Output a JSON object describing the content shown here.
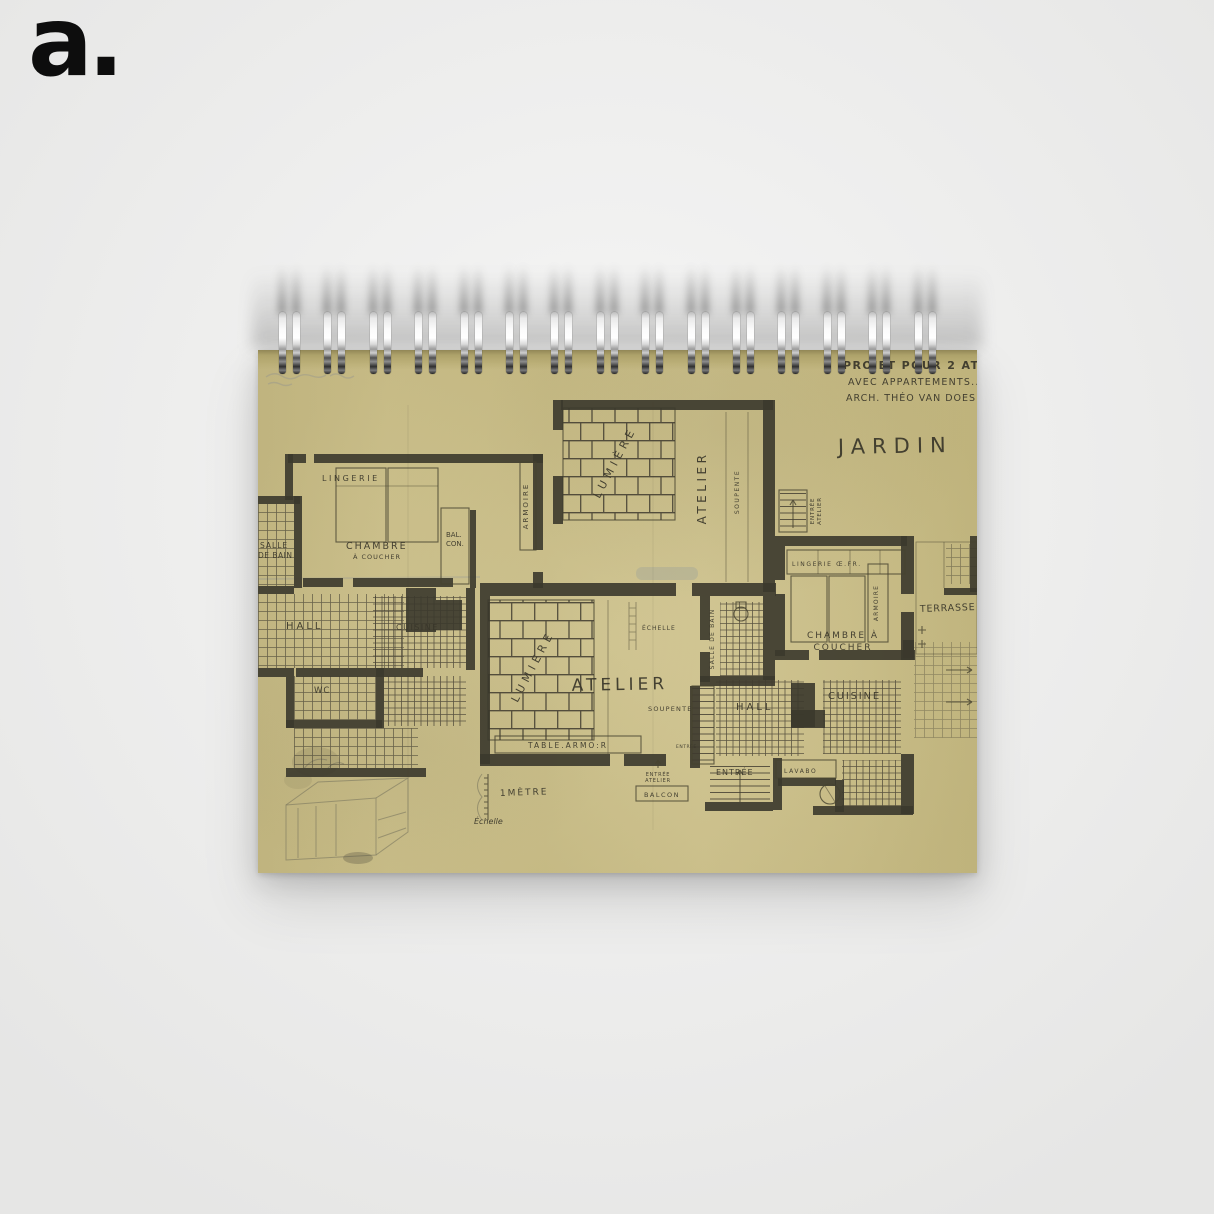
{
  "brand": {
    "logo_text": "a."
  },
  "colors": {
    "background": "#ededec",
    "page": "#cdc18b",
    "ink": "#3b382c",
    "logo": "#0d0d0d"
  },
  "notebook": {
    "binding": {
      "ring_count": 15
    }
  },
  "artwork": {
    "title_block": {
      "line1": "PROJET POUR 2 ATELI",
      "line2": "AVEC APPARTEMENTS..",
      "line3": "ARCH. THÉO VAN DOES:B"
    },
    "garden_label": "JARDIN",
    "scale": {
      "meter": "1MÈTRE",
      "echelle": "Échelle"
    },
    "left_apartment": {
      "lingerie": "LINGERIE",
      "armoire": "ARMOIRE",
      "chambre_line1": "CHAMBRE",
      "chambre_line2": "À COUCHER",
      "balcon_line1": "BAL.",
      "balcon_line2": "CON.",
      "salle_line1": "SALLE",
      "salle_line2": "DE BAIN",
      "hall": "HALL",
      "cuisine": "CUISINE",
      "wc": "WC"
    },
    "top_atelier": {
      "lumiere": "LUMIÈRE",
      "atelier": "ATELIER",
      "soupente": "SOUPENTE",
      "entree": "ENTRÉE",
      "entree_atelier": "ATELIER"
    },
    "main_atelier": {
      "lumiere": "LUMIÈRE",
      "atelier": "ATELIER",
      "echelle_ladder": "ÉCHELLE",
      "soupente": "SOUPENTE",
      "table": "TABLE.ARMO:R",
      "salle_de_bain": "SALLE DE BAIN",
      "entree_tiny": "ENTRÉE",
      "entree_line1": "ENTRÉE",
      "entree_line2": "ATELIER",
      "balcon": "BALCON"
    },
    "right_apartment": {
      "lingerie": "LINGERIE Œ.FR.",
      "armoire": "ARMOIRE",
      "chambre_line1": "CHAMBRE À",
      "chambre_line2": "COUCHER",
      "terrasse": "TERRASSE",
      "hall": "HALL",
      "cuisine": "CUISINE",
      "entree": "ENTRÉE",
      "lavabo": "LAVABO"
    }
  }
}
